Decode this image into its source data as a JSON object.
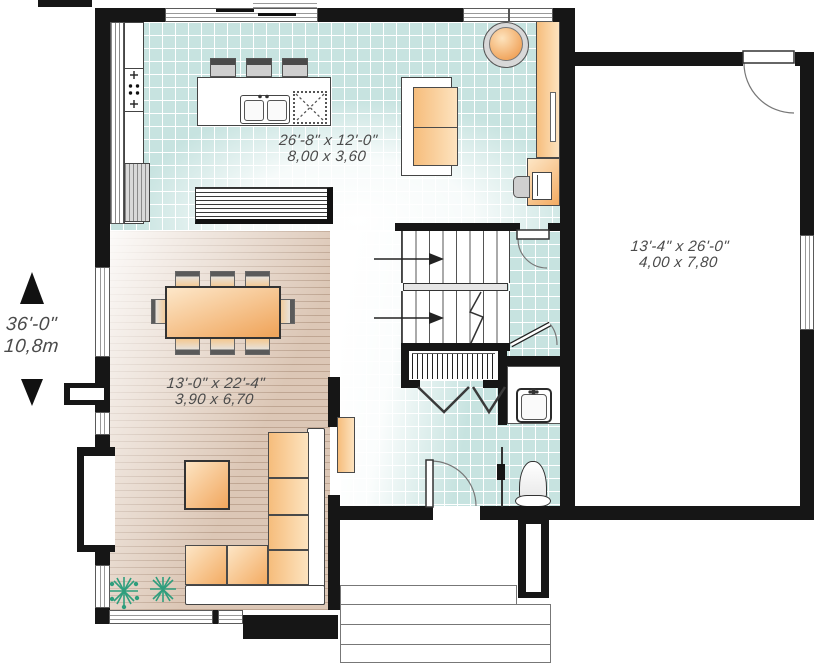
{
  "plan": {
    "rooms": {
      "kitchen_living": {
        "dims_imperial": "26'-8\" x 12'-0\"",
        "dims_metric": "8,00 x 3,60"
      },
      "dining_living": {
        "dims_imperial": "13'-0\" x 22'-4\"",
        "dims_metric": "3,90 x 6,70"
      },
      "garage": {
        "dims_imperial": "13'-4\" x 26'-0\"",
        "dims_metric": "4,00 x 7,80"
      }
    },
    "side_dimension": {
      "imperial": "36'-0\"",
      "metric": "10,8m"
    }
  },
  "colors": {
    "wall": "#161616",
    "tile_teal": "#c7e3e0",
    "wood_tan": "#dcc7b6",
    "furniture_orange_light": "#fde6c6",
    "furniture_orange": "#f3ab62",
    "plant_green": "#2f9e7d",
    "label_gray": "#4b4b4b"
  },
  "icons": {
    "dimension-up-arrow-icon": "filled triangle up",
    "dimension-down-arrow-icon": "filled triangle down",
    "stair-direction-arrow-icon": "right arrow",
    "cooktop-icon": "four burner dots with control crosses",
    "refrigerator-icon": "striped box",
    "double-sink-icon": "two basins with faucet",
    "dishwasher-icon": "dashed X square",
    "bathroom-sink-icon": "basin with faucet",
    "toilet-icon": "bell tank with base",
    "plant-icon": "starburst",
    "stair-break-icon": "zigzag line"
  }
}
